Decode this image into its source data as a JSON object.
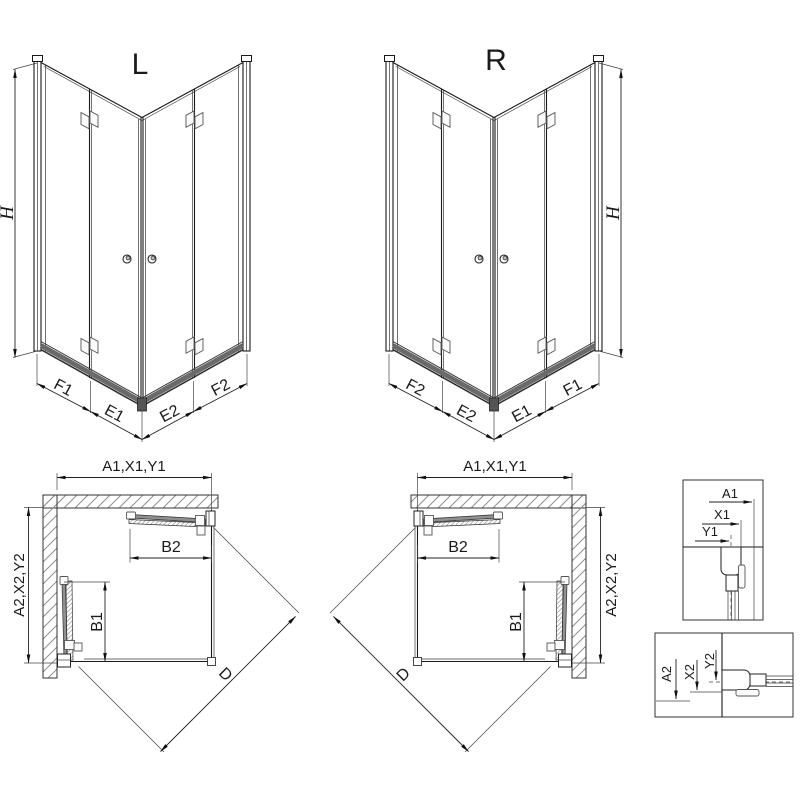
{
  "iso_l": {
    "variant": "L",
    "height": "H",
    "segments": [
      "F1",
      "E1",
      "E2",
      "F2"
    ]
  },
  "iso_r": {
    "variant": "R",
    "height": "H",
    "segments": [
      "F2",
      "E2",
      "E1",
      "F1"
    ]
  },
  "plan_l": {
    "width": "A1,X1,Y1",
    "depth": "A2,X2,Y2",
    "fold_top": "B2",
    "fold_side": "B1",
    "diagonal": "D"
  },
  "plan_r": {
    "width": "A1,X1,Y1",
    "depth": "A2,X2,Y2",
    "fold_top": "B2",
    "fold_side": "B1",
    "diagonal": "D"
  },
  "detail_top": {
    "dims": [
      "A1",
      "X1",
      "Y1"
    ]
  },
  "detail_side": {
    "dims": [
      "A2",
      "X2",
      "Y2"
    ]
  }
}
